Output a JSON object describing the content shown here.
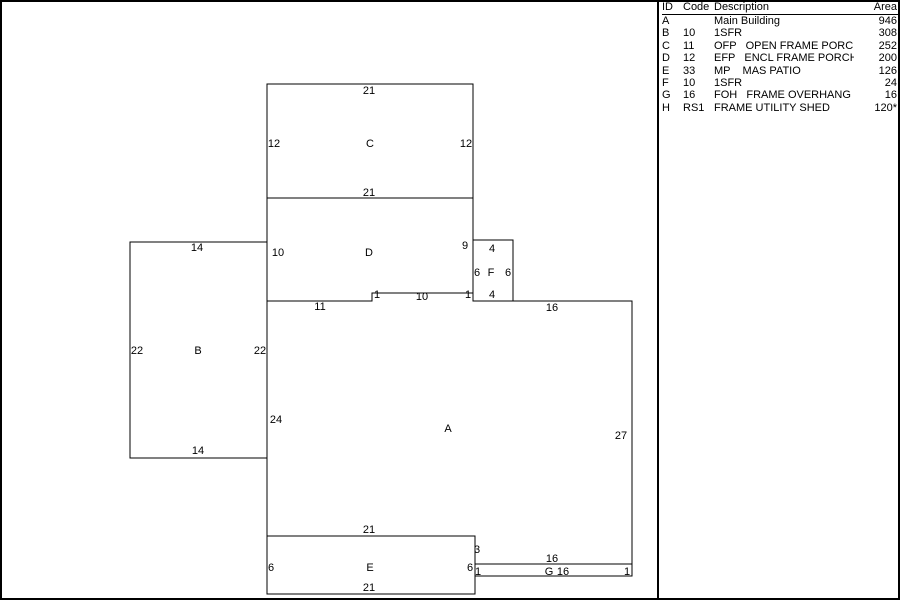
{
  "legend": {
    "headers": [
      "ID",
      "Code",
      "Description",
      "Area"
    ],
    "rows": [
      {
        "id": "A",
        "code": "",
        "description": "Main Building",
        "area": "946"
      },
      {
        "id": "B",
        "code": "10",
        "description": "1SFR",
        "area": "308"
      },
      {
        "id": "C",
        "code": "11",
        "description": "OFP   OPEN FRAME PORCH",
        "area": "252"
      },
      {
        "id": "D",
        "code": "12",
        "description": "EFP   ENCL FRAME PORCH",
        "area": "200"
      },
      {
        "id": "E",
        "code": "33",
        "description": "MP    MAS PATIO",
        "area": "126"
      },
      {
        "id": "F",
        "code": "10",
        "description": "1SFR",
        "area": "24"
      },
      {
        "id": "G",
        "code": "16",
        "description": "FOH   FRAME OVERHANG",
        "area": "16"
      },
      {
        "id": "H",
        "code": "RS1",
        "description": "FRAME UTILITY SHED",
        "area": "120*"
      }
    ]
  },
  "sketch": {
    "background": "#ffffff",
    "stroke": "#000000",
    "shapes": [
      {
        "name": "C",
        "points": "267,84 473,84 473,198 267,198"
      },
      {
        "name": "D",
        "points": "267,198 473,198 473,293 372,293 372,301 267,301"
      },
      {
        "name": "F",
        "points": "473,240 513,240 513,301 473,301"
      },
      {
        "name": "B",
        "points": "130,242 267,242 267,458 130,458"
      },
      {
        "name": "A",
        "points": "267,301 372,301 372,293 473,293 473,301 632,301 632,564 475,564 475,536 267,536"
      },
      {
        "name": "E",
        "points": "267,536 475,536 475,594 267,594"
      },
      {
        "name": "G",
        "points": "475,564 632,564 632,576 475,576"
      }
    ],
    "labels": [
      {
        "t": "21",
        "x": 369,
        "y": 94
      },
      {
        "t": "12",
        "x": 274,
        "y": 147
      },
      {
        "t": "C",
        "x": 370,
        "y": 147,
        "kind": "shape"
      },
      {
        "t": "12",
        "x": 466,
        "y": 147
      },
      {
        "t": "21",
        "x": 369,
        "y": 196
      },
      {
        "t": "10",
        "x": 278,
        "y": 256
      },
      {
        "t": "D",
        "x": 369,
        "y": 256,
        "kind": "shape"
      },
      {
        "t": "9",
        "x": 465,
        "y": 249
      },
      {
        "t": "1",
        "x": 377,
        "y": 298
      },
      {
        "t": "10",
        "x": 422,
        "y": 300
      },
      {
        "t": "1",
        "x": 468,
        "y": 298
      },
      {
        "t": "11",
        "x": 320,
        "y": 310
      },
      {
        "t": "4",
        "x": 492,
        "y": 252
      },
      {
        "t": "6",
        "x": 477,
        "y": 276
      },
      {
        "t": "F",
        "x": 491,
        "y": 276,
        "kind": "shape"
      },
      {
        "t": "6",
        "x": 508,
        "y": 276
      },
      {
        "t": "4",
        "x": 492,
        "y": 298
      },
      {
        "t": "14",
        "x": 197,
        "y": 251
      },
      {
        "t": "22",
        "x": 137,
        "y": 354
      },
      {
        "t": "B",
        "x": 198,
        "y": 354,
        "kind": "shape"
      },
      {
        "t": "22",
        "x": 260,
        "y": 354
      },
      {
        "t": "14",
        "x": 198,
        "y": 454
      },
      {
        "t": "16",
        "x": 552,
        "y": 311
      },
      {
        "t": "24",
        "x": 276,
        "y": 423
      },
      {
        "t": "A",
        "x": 448,
        "y": 432,
        "kind": "shape"
      },
      {
        "t": "27",
        "x": 621,
        "y": 439
      },
      {
        "t": "21",
        "x": 369,
        "y": 533
      },
      {
        "t": "3",
        "x": 477,
        "y": 553
      },
      {
        "t": "16",
        "x": 552,
        "y": 562
      },
      {
        "t": "6",
        "x": 271,
        "y": 571
      },
      {
        "t": "E",
        "x": 370,
        "y": 571,
        "kind": "shape"
      },
      {
        "t": "6",
        "x": 470,
        "y": 571
      },
      {
        "t": "21",
        "x": 369,
        "y": 591
      },
      {
        "t": "1",
        "x": 478,
        "y": 575
      },
      {
        "t": "G",
        "x": 549,
        "y": 575,
        "kind": "shape"
      },
      {
        "t": "16",
        "x": 563,
        "y": 575
      },
      {
        "t": "1",
        "x": 627,
        "y": 575
      }
    ]
  }
}
